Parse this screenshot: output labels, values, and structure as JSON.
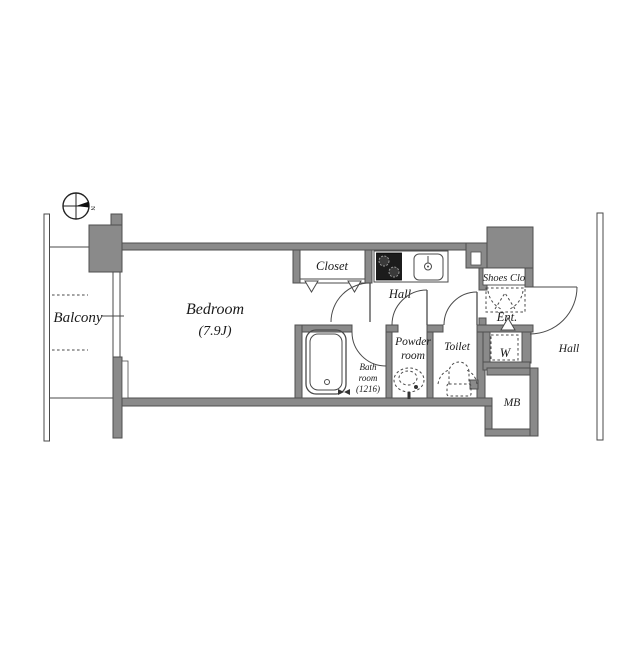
{
  "floorplan": {
    "compass": {
      "north_label": "N"
    },
    "rooms": {
      "balcony": {
        "label": "Balcony"
      },
      "bedroom": {
        "label": "Bedroom",
        "size": "(7.9J)"
      },
      "closet": {
        "label": "Closet"
      },
      "hall_inner": {
        "label": "Hall"
      },
      "bathroom": {
        "line1": "Bath",
        "line2": "room",
        "line3": "(1216)"
      },
      "powder_room": {
        "line1": "Powder",
        "line2": "room"
      },
      "toilet": {
        "label": "Toilet"
      },
      "shoes_closet": {
        "label": "Shoes Clo"
      },
      "entrance": {
        "label": "Ent."
      },
      "washer": {
        "label": "W"
      },
      "meter_box": {
        "label": "MB"
      },
      "hall_outer": {
        "label": "Hall"
      }
    },
    "colors": {
      "wall": "#8a8a8a",
      "wall_border": "#4f4f4f",
      "line": "#4a4a4a",
      "text": "#1a1a1a",
      "bg": "#ffffff",
      "fixture_dark": "#1c1c1c"
    }
  }
}
